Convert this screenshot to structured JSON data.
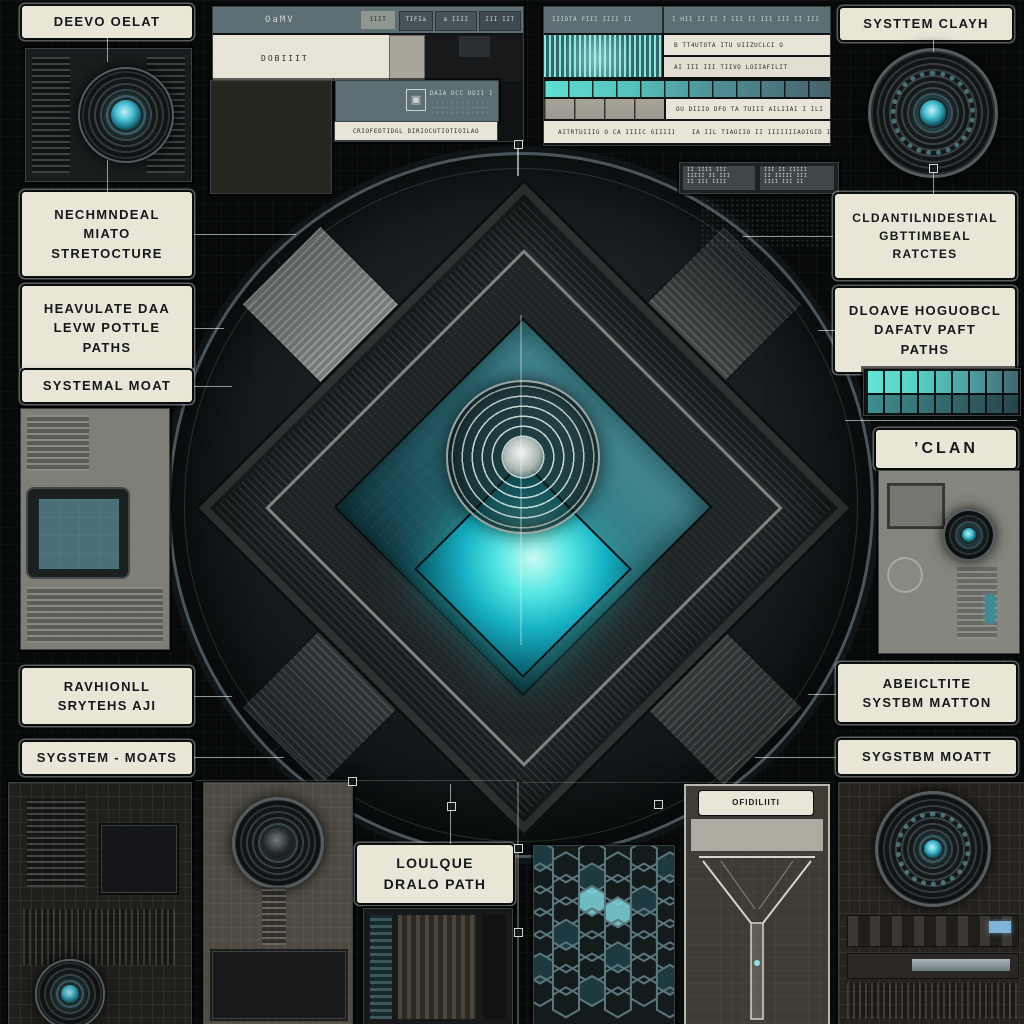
{
  "colors": {
    "accent_teal": "#49c8d6",
    "glow_teal": "#57e8e4",
    "label_bg": "#e9e6d8",
    "slate": "#5d6e74",
    "hex_stroke": "#5b767c",
    "hex_fill_dim": "#1d3a41",
    "hex_fill_bright": "#7fd8dc"
  },
  "labels": {
    "top_left": "DEEVO OELAT",
    "top_right": "SYSTTEM CLAYH",
    "left": [
      {
        "lines": [
          "NECHMNDEAL",
          "MIATO",
          "STRETOCTURE"
        ]
      },
      {
        "lines": [
          "HEAVULATE DAA",
          "LEVW POTTLE",
          "PATHS"
        ]
      },
      {
        "lines": [
          "SYSTEMAL MOAT"
        ]
      },
      {
        "lines": [
          "RAVHIONLL",
          "SRYTEHS AJI"
        ]
      },
      {
        "lines": [
          "SYGSTEM - MOATS"
        ]
      }
    ],
    "right": [
      {
        "lines": [
          "CLDANTILNIDESTIAL",
          "GBTTIMBEAL",
          "RATCTES"
        ]
      },
      {
        "lines": [
          "DLOAVE HOGUOBCL",
          "DAFATV PAFT",
          "PATHS"
        ]
      },
      {
        "lines": [
          "’CLAN"
        ]
      },
      {
        "lines": [
          "ABEICLTITE",
          "SYSTBM MATTON"
        ]
      },
      {
        "lines": [
          "SYGSTBM  MOATT"
        ]
      }
    ],
    "bottom_center": {
      "lines": [
        "LOULQUE",
        "DRALO PATH"
      ]
    },
    "funnel_tag": "OFIDILIITI"
  },
  "panel_a": {
    "title": "OaMV",
    "header_cells": [
      "IIIT",
      "TIFIa",
      "a IIII",
      "III IIT"
    ],
    "row_label": "DOBIIIT",
    "chip_icon": "▣",
    "chip_text": "DAIA DCC DDII I",
    "footer_text": "CRIOFEDTIDGL DIRIOCUTIOTIOILAO"
  },
  "panel_b": {
    "header_left": "IIIDTA FIII IIII II",
    "header_right": "I HII II II I III II III III II III",
    "row1_text": "B TT4UTOTA ITU UIIZUCLCI O",
    "row2_text": "AI III III TIIVO LOIIAFILIT",
    "row3_text": "OU DIIIO DFO TA TUIII AILIIAI I ILI",
    "row4_left": "AITRTUIIIG O CA IIIIC GIIIIII",
    "row4_right": "IA IIL TIAOIIO II IIIIIIIAOIGID IO"
  },
  "sub_panel": {
    "cell1_lines": [
      "II IIII III",
      "IIIII II III",
      "II III IIII"
    ],
    "cell2_lines": [
      "III II IIIII",
      "II IIIII III",
      "IIII III II"
    ]
  }
}
